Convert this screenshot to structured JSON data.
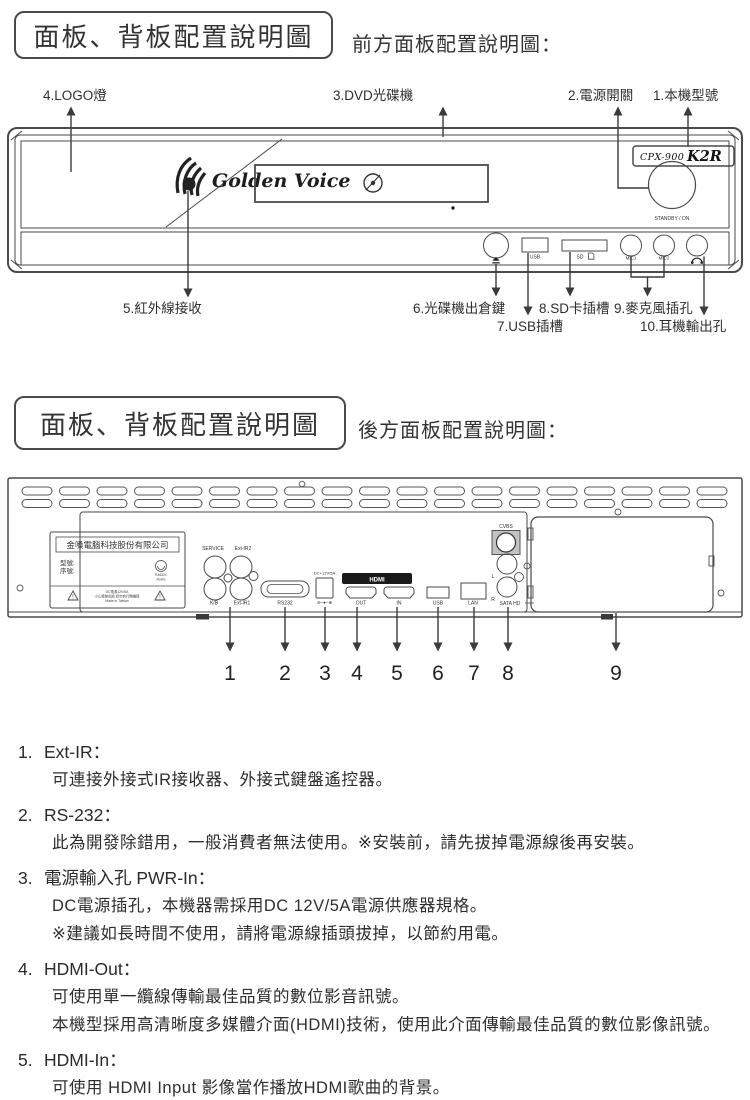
{
  "colors": {
    "ink": "#2f2f2f",
    "panel_line": "#4a4a4a",
    "hdmi_bar": "#1a1a1a"
  },
  "section1": {
    "title": "面板、背板配置說明圖",
    "subtitle": "前方面板配置說明圖："
  },
  "section2": {
    "title": "面板、背板配置說明圖",
    "subtitle": "後方面板配置說明圖："
  },
  "front_panel": {
    "callouts_top": [
      "4.LOGO燈",
      "3.DVD光碟機",
      "2.電源開關",
      "1.本機型號"
    ],
    "callouts_bottom": [
      "5.紅外線接收",
      "6.光碟機出倉鍵",
      "7.USB插槽",
      "8.SD卡插槽",
      "9.麥克風插孔",
      "10.耳機輸出孔"
    ],
    "brand": "Golden Voice",
    "model_prefix": "CPX-900",
    "model_suffix": "K2R",
    "power_label": "STANDBY / ON",
    "ports": {
      "usb": "USB",
      "sd": "SD",
      "mic1": "MIC1",
      "mic2": "MIC2"
    }
  },
  "back_panel": {
    "sticker": {
      "company": "金嗓電腦科技股份有限公司",
      "model_row": "型號:",
      "serial_row": "序號:",
      "rohs_code": "R46321",
      "rohs": "RoHS",
      "warn_line1": "DC電源12V/5A",
      "warn_line2": "小心電擊危險 請勿自行開機殼",
      "warn_line3": "Made in Taiwan"
    },
    "ports": {
      "service": "SERVICE",
      "ext_ir2": "Ext-IR2",
      "kb": "K/B",
      "ext_ir1": "Ext-IR1",
      "rs232": "RS232",
      "dc": "DC+12V/5A",
      "polarity": "⊖–●–⊕",
      "hdmi": "HDMI",
      "out": "OUT",
      "in": "IN",
      "usb": "USB",
      "lan": "LAN",
      "cvbs": "CVBS",
      "l": "L",
      "r": "R",
      "sata": "SATA HD"
    },
    "numbers": [
      "1",
      "2",
      "3",
      "4",
      "5",
      "6",
      "7",
      "8",
      "9"
    ]
  },
  "notes": [
    {
      "num": "1.",
      "title": "Ext-IR：",
      "lines": [
        "可連接外接式IR接收器、外接式鍵盤遙控器。"
      ]
    },
    {
      "num": "2.",
      "title": "RS-232：",
      "lines": [
        "此為開發除錯用，一般消費者無法使用。※安裝前，請先拔掉電源線後再安裝。"
      ]
    },
    {
      "num": "3.",
      "title": "電源輸入孔 PWR-In：",
      "lines": [
        "DC電源插孔，本機器需採用DC 12V/5A電源供應器規格。",
        "※建議如長時間不使用，請將電源線插頭拔掉，以節約用電。"
      ]
    },
    {
      "num": "4.",
      "title": "HDMI-Out：",
      "lines": [
        "可使用單一纜線傳輸最佳品質的數位影音訊號。",
        "本機型採用高清晰度多媒體介面(HDMI)技術，使用此介面傳輸最佳品質的數位影像訊號。"
      ]
    },
    {
      "num": "5.",
      "title": "HDMI-In：",
      "lines": [
        "可使用 HDMI Input 影像當作播放HDMI歌曲的背景。"
      ]
    }
  ]
}
